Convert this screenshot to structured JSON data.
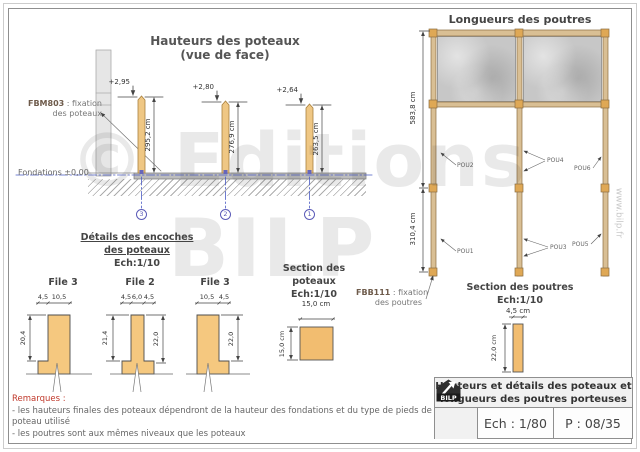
{
  "page": {
    "watermark_line1": "© Editions",
    "watermark_line2": "BILP",
    "watermark_site": "www.bilp.fr"
  },
  "elevation": {
    "title": "Hauteurs des poteaux",
    "subtitle": "(vue de face)",
    "fixation_code": "FBM803",
    "fixation_text": " : fixation",
    "fixation_text2": "des poteaux",
    "foundation_label": "Fondations ±0,00",
    "posts": [
      {
        "level": "+2,95",
        "height": "295,2 cm",
        "axis": "3"
      },
      {
        "level": "+2,80",
        "height": "276,9 cm",
        "axis": "2"
      },
      {
        "level": "+2,64",
        "height": "263,5 cm",
        "axis": "1"
      }
    ]
  },
  "notch_details": {
    "title": "Détails des encoches",
    "title2": "des poteaux",
    "scale": "Ech:1/10",
    "items": [
      {
        "name": "File 3",
        "dims_top": [
          "4,5",
          "10,5"
        ],
        "dim_left": "20,4",
        "dim_right": ""
      },
      {
        "name": "File 2",
        "dims_top": [
          "4,5",
          "6,0",
          "4,5"
        ],
        "dim_left": "21,4",
        "dim_right": "22,0"
      },
      {
        "name": "File 3",
        "dims_top": [
          "10,5",
          "4,5"
        ],
        "dim_left": "",
        "dim_right": "22,0"
      }
    ]
  },
  "post_section": {
    "title": "Section des",
    "title2": "poteaux",
    "scale": "Ech:1/10",
    "dim_width": "15,0 cm",
    "dim_height": "15,0 cm"
  },
  "beam_plan": {
    "title": "Longueurs des poutres",
    "dim_top": "583,8 cm",
    "dim_bottom": "310,4 cm",
    "labels": {
      "pou1": "POU1",
      "pou2": "POU2",
      "pou3": "POU3",
      "pou4": "POU4",
      "pou5": "POU5",
      "pou6": "POU6"
    },
    "fixation_code": "FBB111",
    "fixation_text": " : fixation",
    "fixation_text2": "des poutres"
  },
  "beam_section": {
    "title": "Section des poutres",
    "scale": "Ech:1/10",
    "dim_width": "4,5 cm",
    "dim_height": "22,0 cm"
  },
  "title_block": {
    "title_line1": "Hauteurs et détails des poteaux et",
    "title_line2": "longueurs des poutres porteuses",
    "logo": "BILP",
    "scale": "Ech : 1/80",
    "page": "P : 08/35"
  },
  "remarks": {
    "heading": "Remarques :",
    "lines": [
      "- les hauteurs finales des poteaux dépendront de la hauteur des fondations et du type de pieds de poteau utilisé",
      "- les poutres sont aux mêmes niveaux que les poteaux"
    ]
  },
  "colors": {
    "wood": "#F0C883",
    "beam_wood": "#D9BF94",
    "concrete": "#C7C7C7",
    "axis_blue": "#5B5BB8",
    "remark_red": "#C0392B"
  }
}
